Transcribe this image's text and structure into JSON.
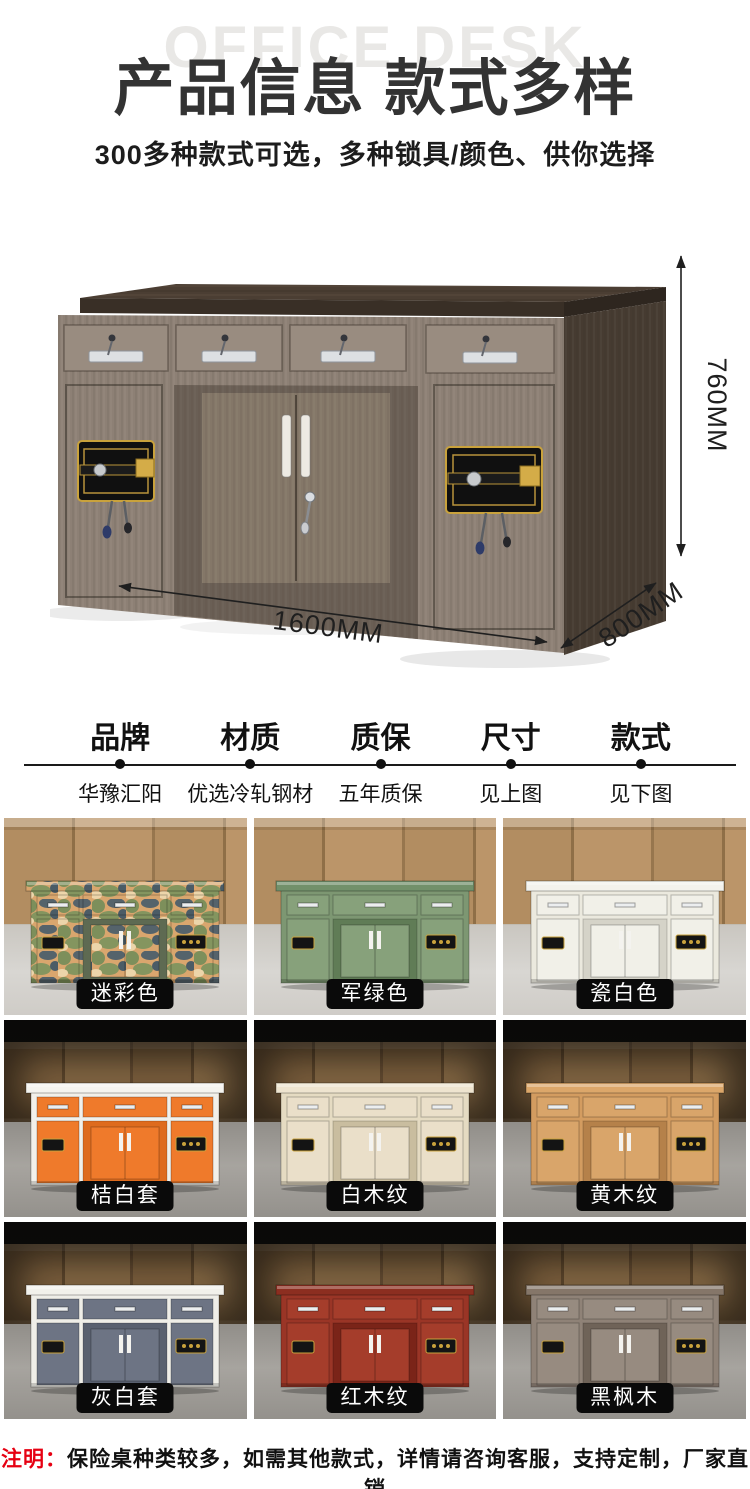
{
  "page": {
    "watermark": "OFFICE DESK",
    "title": "产品信息 款式多样",
    "subtitle": "300多种款式可选，多种锁具/颜色、供你选择"
  },
  "dimensions": {
    "height": "760MM",
    "width": "1600MM",
    "depth": "800MM"
  },
  "specs": [
    {
      "label": "品牌",
      "value": "华豫汇阳"
    },
    {
      "label": "材质",
      "value": "优选冷轧钢材"
    },
    {
      "label": "质保",
      "value": "五年质保"
    },
    {
      "label": "尺寸",
      "value": "见上图"
    },
    {
      "label": "款式",
      "value": "见下图"
    }
  ],
  "styles": [
    {
      "label": "迷彩色",
      "scene": "light",
      "camo": true,
      "colors": {
        "top": "#dfa977",
        "frame": "#d9a66e",
        "drawer": "#d9a66e",
        "inset": "#5e6a52"
      }
    },
    {
      "label": "军绿色",
      "scene": "light",
      "camo": false,
      "colors": {
        "top": "#72906a",
        "frame": "#7d9772",
        "drawer": "#87a17b",
        "inset": "#607c56"
      }
    },
    {
      "label": "瓷白色",
      "scene": "light",
      "camo": false,
      "colors": {
        "top": "#f3f2ec",
        "frame": "#ebe9de",
        "drawer": "#f1f0e8",
        "inset": "#d5d3c8"
      }
    },
    {
      "label": "桔白套",
      "scene": "dark",
      "camo": false,
      "colors": {
        "top": "#f5f4ef",
        "frame": "#f2f0ea",
        "drawer": "#ef7a2b",
        "inset": "#de6b1e"
      }
    },
    {
      "label": "白木纹",
      "scene": "dark",
      "camo": false,
      "colors": {
        "top": "#eee4cf",
        "frame": "#e5dbc2",
        "drawer": "#eadfc9",
        "inset": "#c9bd9f"
      }
    },
    {
      "label": "黄木纹",
      "scene": "dark",
      "camo": false,
      "colors": {
        "top": "#dca76a",
        "frame": "#d39c60",
        "drawer": "#d9a56a",
        "inset": "#b5814a"
      }
    },
    {
      "label": "灰白套",
      "scene": "dark",
      "camo": false,
      "colors": {
        "top": "#f2f1eb",
        "frame": "#efeee8",
        "drawer": "#6d7484",
        "inset": "#59606f"
      }
    },
    {
      "label": "红木纹",
      "scene": "dark",
      "camo": false,
      "colors": {
        "top": "#8c2e20",
        "frame": "#9a3526",
        "drawer": "#a53d2b",
        "inset": "#7a2418"
      }
    },
    {
      "label": "黑枫木",
      "scene": "dark",
      "camo": false,
      "colors": {
        "top": "#857669",
        "frame": "#8f8277",
        "drawer": "#978b80",
        "inset": "#6f6358"
      }
    }
  ],
  "note": {
    "prefix": "注明：",
    "text": "保险桌种类较多，如需其他款式，详情请咨询客服，支持定制，厂家直销"
  },
  "accent": {
    "red": "#e60012",
    "pill_bg": "#0a0a0a",
    "pill_text": "#ffffff",
    "gold": "#c9a23c"
  }
}
